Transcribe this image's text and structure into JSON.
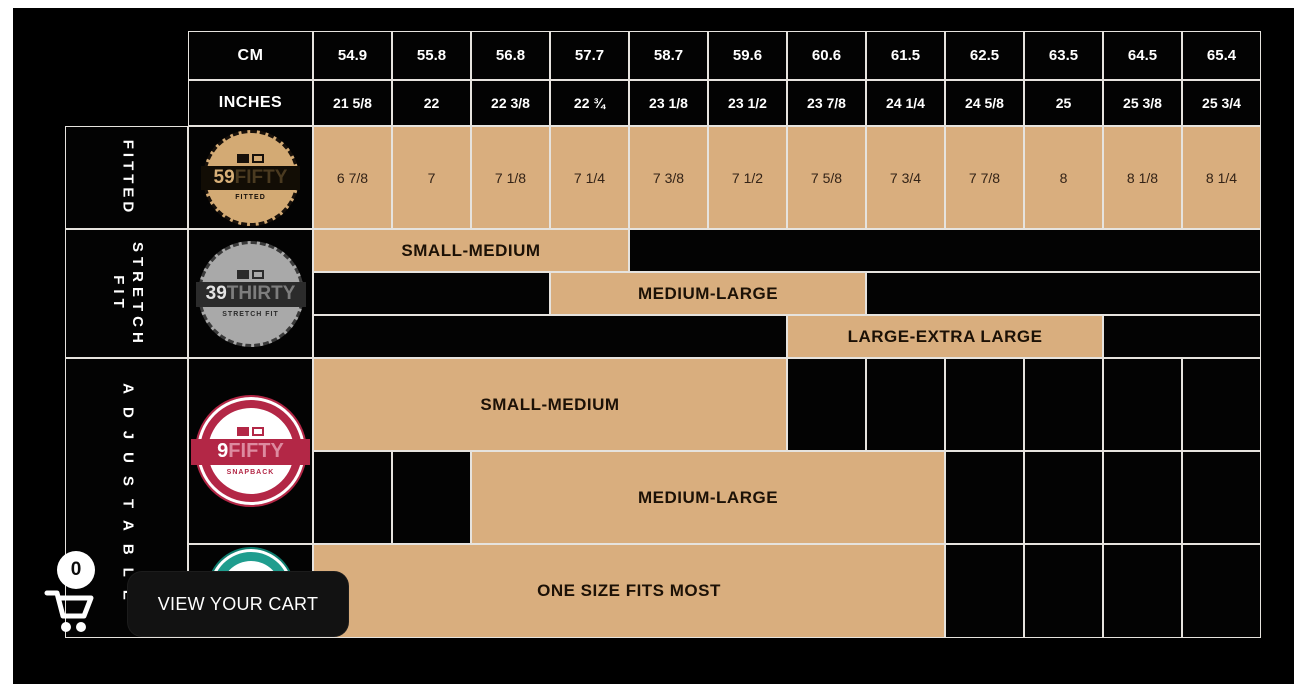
{
  "header": {
    "cm_label": "CM",
    "inches_label": "INCHES",
    "cm_values": [
      "54.9",
      "55.8",
      "56.8",
      "57.7",
      "58.7",
      "59.6",
      "60.6",
      "61.5",
      "62.5",
      "63.5",
      "64.5",
      "65.4"
    ],
    "inches_values": [
      "21 5/8",
      "22",
      "22 3/8",
      "22 ¾",
      "23 1/8",
      "23 1/2",
      "23 7/8",
      "24 1/4",
      "24 5/8",
      "25",
      "25 3/8",
      "25 3/4"
    ]
  },
  "sections": {
    "fitted": {
      "label": "FITTED",
      "badge": {
        "brand_number": "59",
        "brand_word": "FIFTY",
        "subtitle": "FITTED"
      },
      "sizes": [
        "6 7/8",
        "7",
        "7 1/8",
        "7 1/4",
        "7 3/8",
        "7 1/2",
        "7 5/8",
        "7 3/4",
        "7 7/8",
        "8",
        "8 1/8",
        "8 1/4"
      ]
    },
    "stretch_fit": {
      "label": "STRETCH FIT",
      "badge": {
        "brand_number": "39",
        "brand_word": "THIRTY",
        "subtitle": "STRETCH FIT"
      },
      "bars": {
        "small_medium": "SMALL-MEDIUM",
        "medium_large": "MEDIUM-LARGE",
        "large_extra_large": "LARGE-EXTRA LARGE"
      }
    },
    "adjustable": {
      "label": "ADJUSTABLE",
      "badge": {
        "brand_number": "9",
        "brand_word": "FIFTY",
        "subtitle": "SNAPBACK"
      },
      "bars": {
        "small_medium": "SMALL-MEDIUM",
        "medium_large": "MEDIUM-LARGE",
        "one_size": "ONE SIZE FITS MOST"
      }
    }
  },
  "cart": {
    "count": "0",
    "button_label": "VIEW YOUR CART"
  },
  "colors": {
    "tan_cell": "#d9ae7e",
    "gold_badge": "#d3aa74",
    "silver_badge": "#a9a9a9",
    "crimson_badge": "#b32746",
    "teal_badge": "#1f9d8e",
    "grid_line": "#e6e3de",
    "canvas": "#000000"
  }
}
